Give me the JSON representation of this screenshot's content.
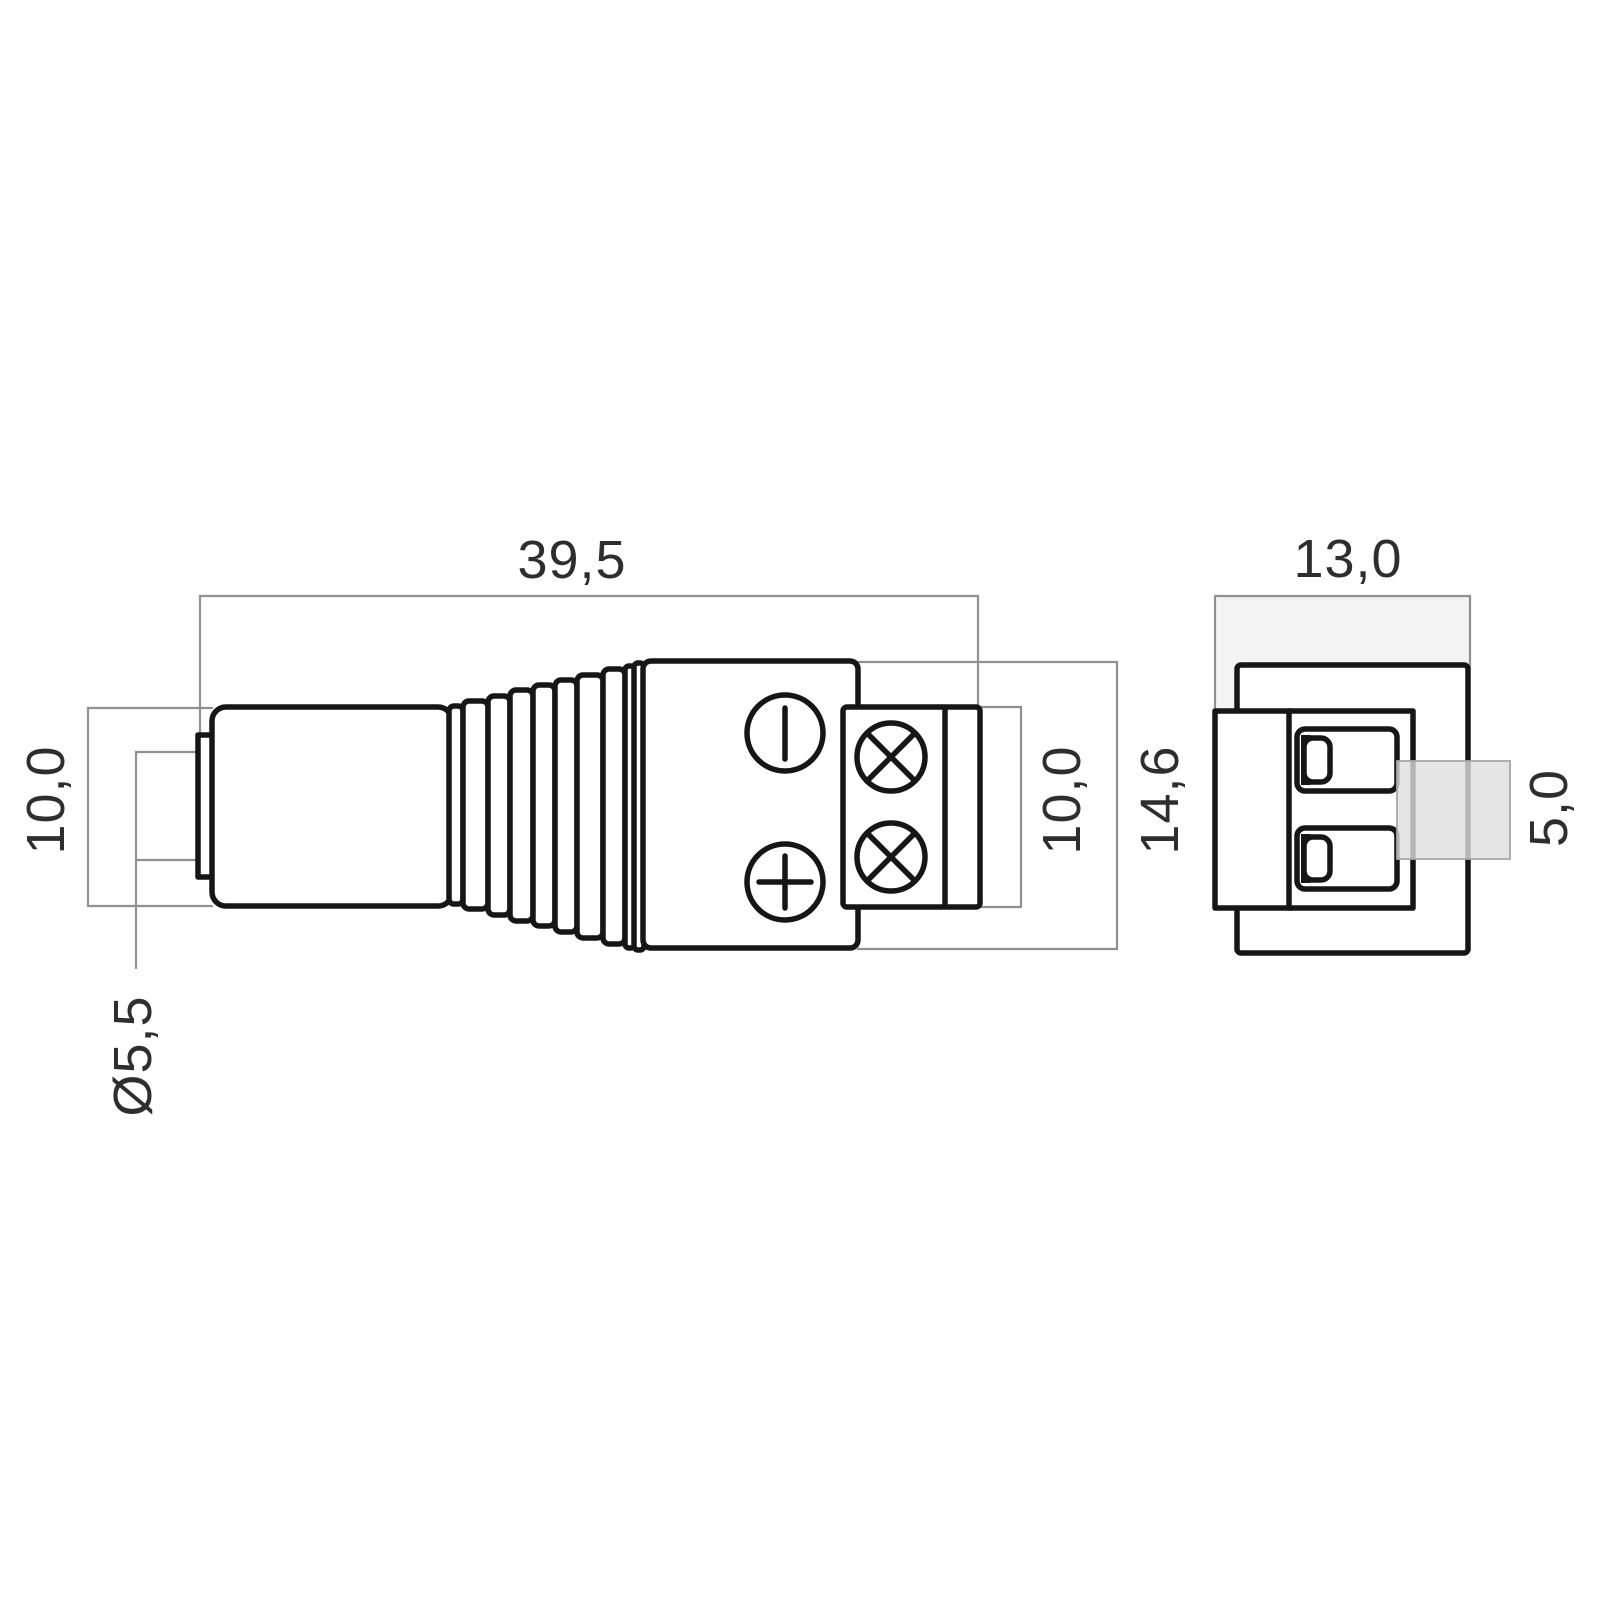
{
  "drawing": {
    "type": "technical-dimension-drawing",
    "subject": "DC barrel plug with screw terminal block, side view and end view",
    "dimensions": {
      "overall_length": {
        "label": "39,5"
      },
      "plug_height_left": {
        "label": "10,0"
      },
      "tip_diameter": {
        "label": "Ø5,5"
      },
      "terminal_block_height": {
        "label": "10,0"
      },
      "housing_height": {
        "label": "14,6"
      },
      "end_view_width": {
        "label": "13,0"
      },
      "terminal_pitch": {
        "label": "5,0"
      }
    },
    "symbols": {
      "negative_terminal": "circle with vertical bar",
      "positive_terminal": "circle with plus cross",
      "screw": "circle with diagonal cross"
    },
    "colors": {
      "outline": "#161616",
      "dimension_line": "#909090",
      "dimension_text": "#2e2e2e",
      "shade_light": "#f3f3f3",
      "shade_medium": "#dedede",
      "background": "#ffffff"
    }
  }
}
